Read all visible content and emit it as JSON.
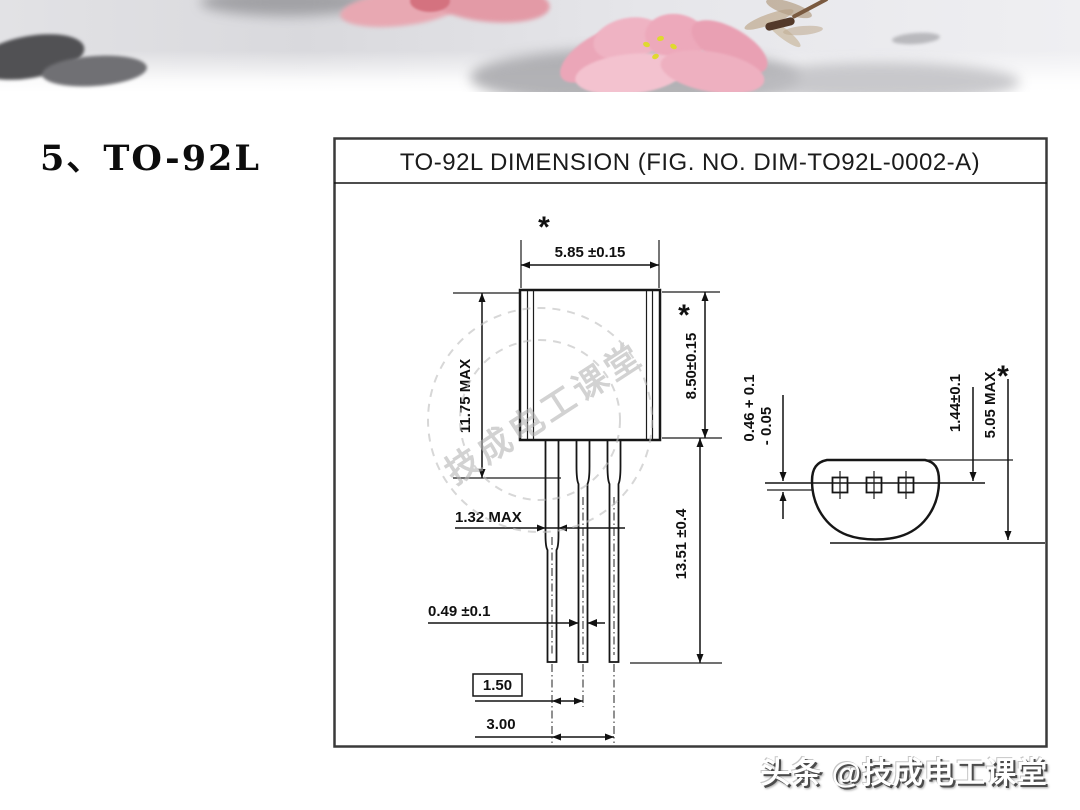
{
  "slide": {
    "heading": "5、TO-92L"
  },
  "diagram": {
    "title": "TO-92L DIMENSION (FIG. NO. DIM-TO92L-0002-A)",
    "asterisk": "*",
    "front_view": {
      "body_width": "5.85 ±0.15",
      "overall_height": "11.75 MAX",
      "body_height": "8.50±0.15",
      "lead_length": "13.51 ±0.4",
      "lead_width_wide": "1.32 MAX",
      "lead_width_narrow": "0.49 ±0.1",
      "lead_pitch": "1.50",
      "lead_span": "3.00"
    },
    "bottom_view": {
      "standoff_value": "0.46 + 0.1",
      "standoff_tolerance": "- 0.05",
      "flat_to_lead": "1.44±0.1",
      "overall_depth": "5.05 MAX"
    }
  },
  "watermark": {
    "text": "技成电工课堂"
  },
  "footer": {
    "credit": "头条 @技成电工课堂"
  }
}
